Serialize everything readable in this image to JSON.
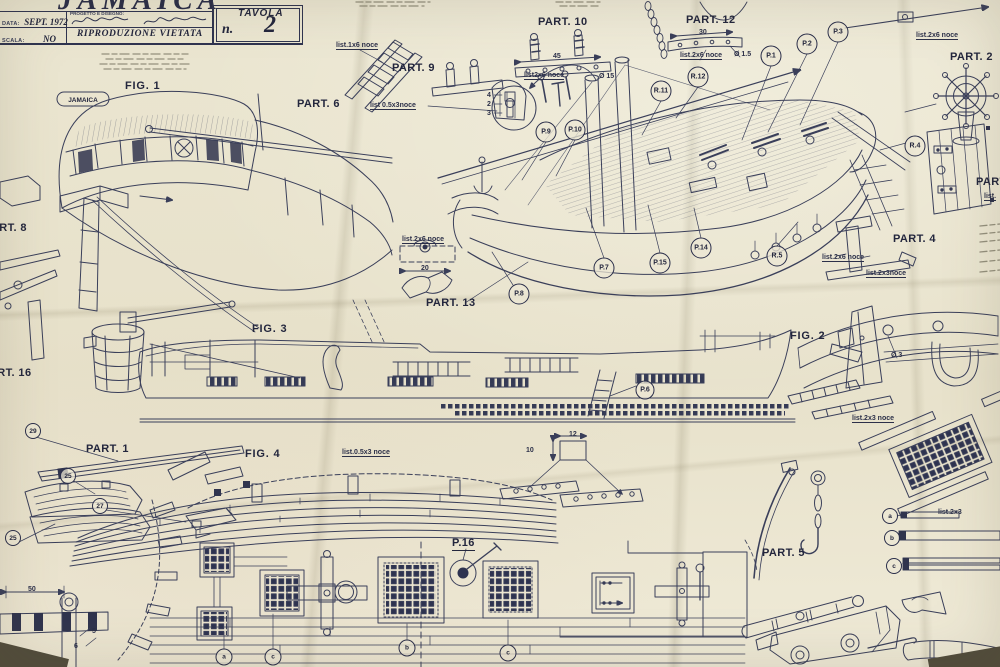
{
  "colors": {
    "paper": "#e8e3cd",
    "ink": "#3a3f5a",
    "text": "#23263d"
  },
  "title_block": {
    "title": "JAMAICA",
    "data_label": "DATA:",
    "data_value": "SEPT. 1972",
    "scala_label": "SCALA:",
    "scala_value": "NO",
    "progetto_label": "PROGETTO E DISEGNO:",
    "riproduzione": "RIPRODUZIONE VIETATA",
    "tavola_label": "TAVOLA",
    "tavola_n": "n.",
    "tavola_number": "2"
  },
  "fig1_nameplate": "JAMAICA",
  "labels": [
    {
      "text": "FIG. 1",
      "x": 125,
      "y": 80,
      "cls": "fig",
      "name": "fig1-label"
    },
    {
      "text": "FIG. 2",
      "x": 790,
      "y": 330,
      "cls": "fig",
      "name": "fig2-label"
    },
    {
      "text": "FIG. 3",
      "x": 252,
      "y": 323,
      "cls": "fig",
      "name": "fig3-label"
    },
    {
      "text": "FIG. 4",
      "x": 245,
      "y": 448,
      "cls": "fig",
      "name": "fig4-label"
    },
    {
      "text": "PART. 6",
      "x": 297,
      "y": 98,
      "cls": "part",
      "name": "part6-label"
    },
    {
      "text": "PART. 9",
      "x": 392,
      "y": 62,
      "cls": "part",
      "name": "part9-label"
    },
    {
      "text": "PART. 10",
      "x": 538,
      "y": 16,
      "cls": "part",
      "name": "part10-label"
    },
    {
      "text": "PART. 12",
      "x": 686,
      "y": 14,
      "cls": "part",
      "name": "part12-label"
    },
    {
      "text": "PART. 2",
      "x": 950,
      "y": 51,
      "cls": "part",
      "name": "part2-label"
    },
    {
      "text": "PART.",
      "x": 976,
      "y": 176,
      "cls": "part",
      "name": "part3-label"
    },
    {
      "text": "PART. 4",
      "x": 893,
      "y": 233,
      "cls": "part",
      "name": "part4-label"
    },
    {
      "text": "PART. 13",
      "x": 426,
      "y": 297,
      "cls": "part",
      "name": "part13-label"
    },
    {
      "text": "PART. 8",
      "x": -16,
      "y": 222,
      "cls": "part",
      "name": "part8-label"
    },
    {
      "text": "PART. 16",
      "x": -18,
      "y": 367,
      "cls": "part",
      "name": "part16-label"
    },
    {
      "text": "PART. 1",
      "x": 86,
      "y": 443,
      "cls": "part",
      "name": "part1-label"
    },
    {
      "text": "PART. 5",
      "x": 762,
      "y": 547,
      "cls": "part",
      "name": "part5-label"
    },
    {
      "text": "P.16",
      "x": 452,
      "y": 537,
      "cls": "part u",
      "name": "p16-label"
    }
  ],
  "annotations": [
    {
      "t": "list.1x6 noce",
      "x": 336,
      "y": 42,
      "u": 1
    },
    {
      "t": "list 0.5x3noce",
      "x": 370,
      "y": 102,
      "u": 1
    },
    {
      "t": "45",
      "x": 553,
      "y": 53
    },
    {
      "t": "list2x6 noce",
      "x": 524,
      "y": 72,
      "u": 1
    },
    {
      "t": "Ø 15",
      "x": 599,
      "y": 73
    },
    {
      "t": "30",
      "x": 699,
      "y": 29
    },
    {
      "t": "list.2x6 noce",
      "x": 680,
      "y": 52,
      "u": 1
    },
    {
      "t": "Ø 1.5",
      "x": 734,
      "y": 51
    },
    {
      "t": "list.2x6 noce",
      "x": 916,
      "y": 32,
      "u": 1
    },
    {
      "t": "list.2x6 noce",
      "x": 402,
      "y": 236,
      "u": 1
    },
    {
      "t": "20",
      "x": 421,
      "y": 265
    },
    {
      "t": "list.2x6 noce",
      "x": 822,
      "y": 254,
      "u": 1
    },
    {
      "t": "list.2x3noce",
      "x": 866,
      "y": 270,
      "u": 1
    },
    {
      "t": "Ø 3",
      "x": 891,
      "y": 352
    },
    {
      "t": "list.2x3 noce",
      "x": 852,
      "y": 415,
      "u": 1
    },
    {
      "t": "list.0.5x3 noce",
      "x": 342,
      "y": 449,
      "u": 1
    },
    {
      "t": "12",
      "x": 569,
      "y": 431
    },
    {
      "t": "10",
      "x": 526,
      "y": 447
    },
    {
      "t": "50",
      "x": 28,
      "y": 586
    },
    {
      "t": "6",
      "x": 74,
      "y": 643
    },
    {
      "t": "5",
      "x": 92,
      "y": 628
    },
    {
      "t": "list.2x3",
      "x": 938,
      "y": 509
    },
    {
      "t": "4",
      "x": 487,
      "y": 92
    },
    {
      "t": "2",
      "x": 487,
      "y": 101
    },
    {
      "t": "3",
      "x": 487,
      "y": 110
    },
    {
      "t": "list.",
      "x": 984,
      "y": 193,
      "u": 1
    }
  ],
  "callouts": [
    {
      "t": "P.1",
      "cx": 771,
      "cy": 56
    },
    {
      "t": "P.2",
      "cx": 807,
      "cy": 44
    },
    {
      "t": "P.3",
      "cx": 838,
      "cy": 32
    },
    {
      "t": "R.12",
      "cx": 698,
      "cy": 77
    },
    {
      "t": "R.11",
      "cx": 661,
      "cy": 91
    },
    {
      "t": "P.9",
      "cx": 546,
      "cy": 132
    },
    {
      "t": "P.10",
      "cx": 575,
      "cy": 130
    },
    {
      "t": "P.7",
      "cx": 604,
      "cy": 268
    },
    {
      "t": "P.15",
      "cx": 660,
      "cy": 263
    },
    {
      "t": "P.14",
      "cx": 701,
      "cy": 248
    },
    {
      "t": "R.5",
      "cx": 777,
      "cy": 256
    },
    {
      "t": "P.8",
      "cx": 519,
      "cy": 294
    },
    {
      "t": "R.4",
      "cx": 915,
      "cy": 146
    },
    {
      "t": "P.6",
      "cx": 645,
      "cy": 390,
      "d": 17
    },
    {
      "t": "a",
      "cx": 224,
      "cy": 657,
      "d": 15
    },
    {
      "t": "c",
      "cx": 273,
      "cy": 657,
      "d": 15
    },
    {
      "t": "b",
      "cx": 407,
      "cy": 648,
      "d": 15
    },
    {
      "t": "c",
      "cx": 508,
      "cy": 653,
      "d": 15
    },
    {
      "t": "a",
      "cx": 890,
      "cy": 516,
      "d": 14
    },
    {
      "t": "b",
      "cx": 892,
      "cy": 538,
      "d": 14
    },
    {
      "t": "c",
      "cx": 894,
      "cy": 566,
      "d": 14
    },
    {
      "t": "29",
      "cx": 33,
      "cy": 431,
      "d": 14
    },
    {
      "t": "25",
      "cx": 68,
      "cy": 476,
      "d": 14
    },
    {
      "t": "27",
      "cx": 100,
      "cy": 506,
      "d": 14
    },
    {
      "t": "25",
      "cx": 13,
      "cy": 538,
      "d": 14
    }
  ]
}
